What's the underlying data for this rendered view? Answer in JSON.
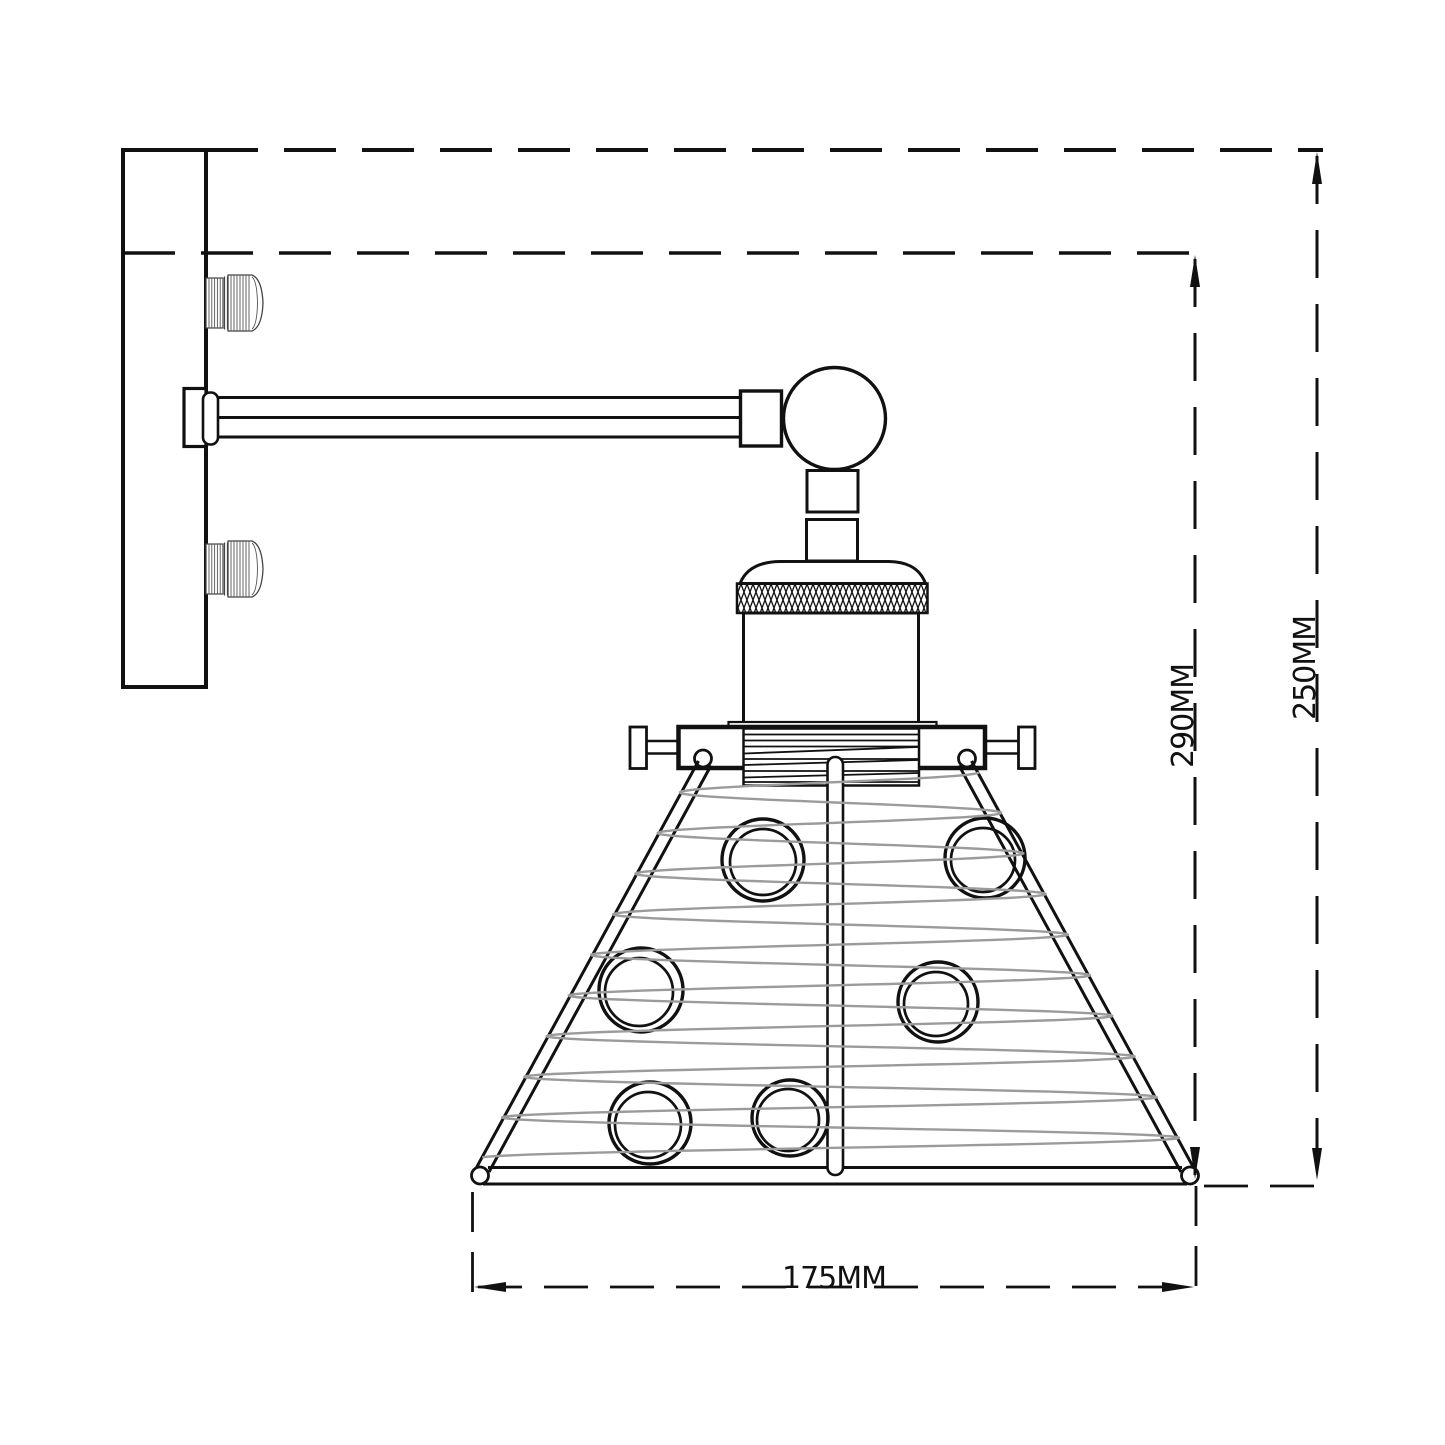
{
  "drawing": {
    "type": "technical-line-drawing",
    "subject": "industrial wall sconce lamp with cone cage shade, side elevation",
    "dimensions": {
      "overall_height_label": "250MM",
      "drop_height_label": "290MM",
      "shade_width_label": "175MM"
    },
    "colors": {
      "line": "#111111",
      "cage_wire": "#9b9b9b",
      "background": "#ffffff"
    }
  }
}
